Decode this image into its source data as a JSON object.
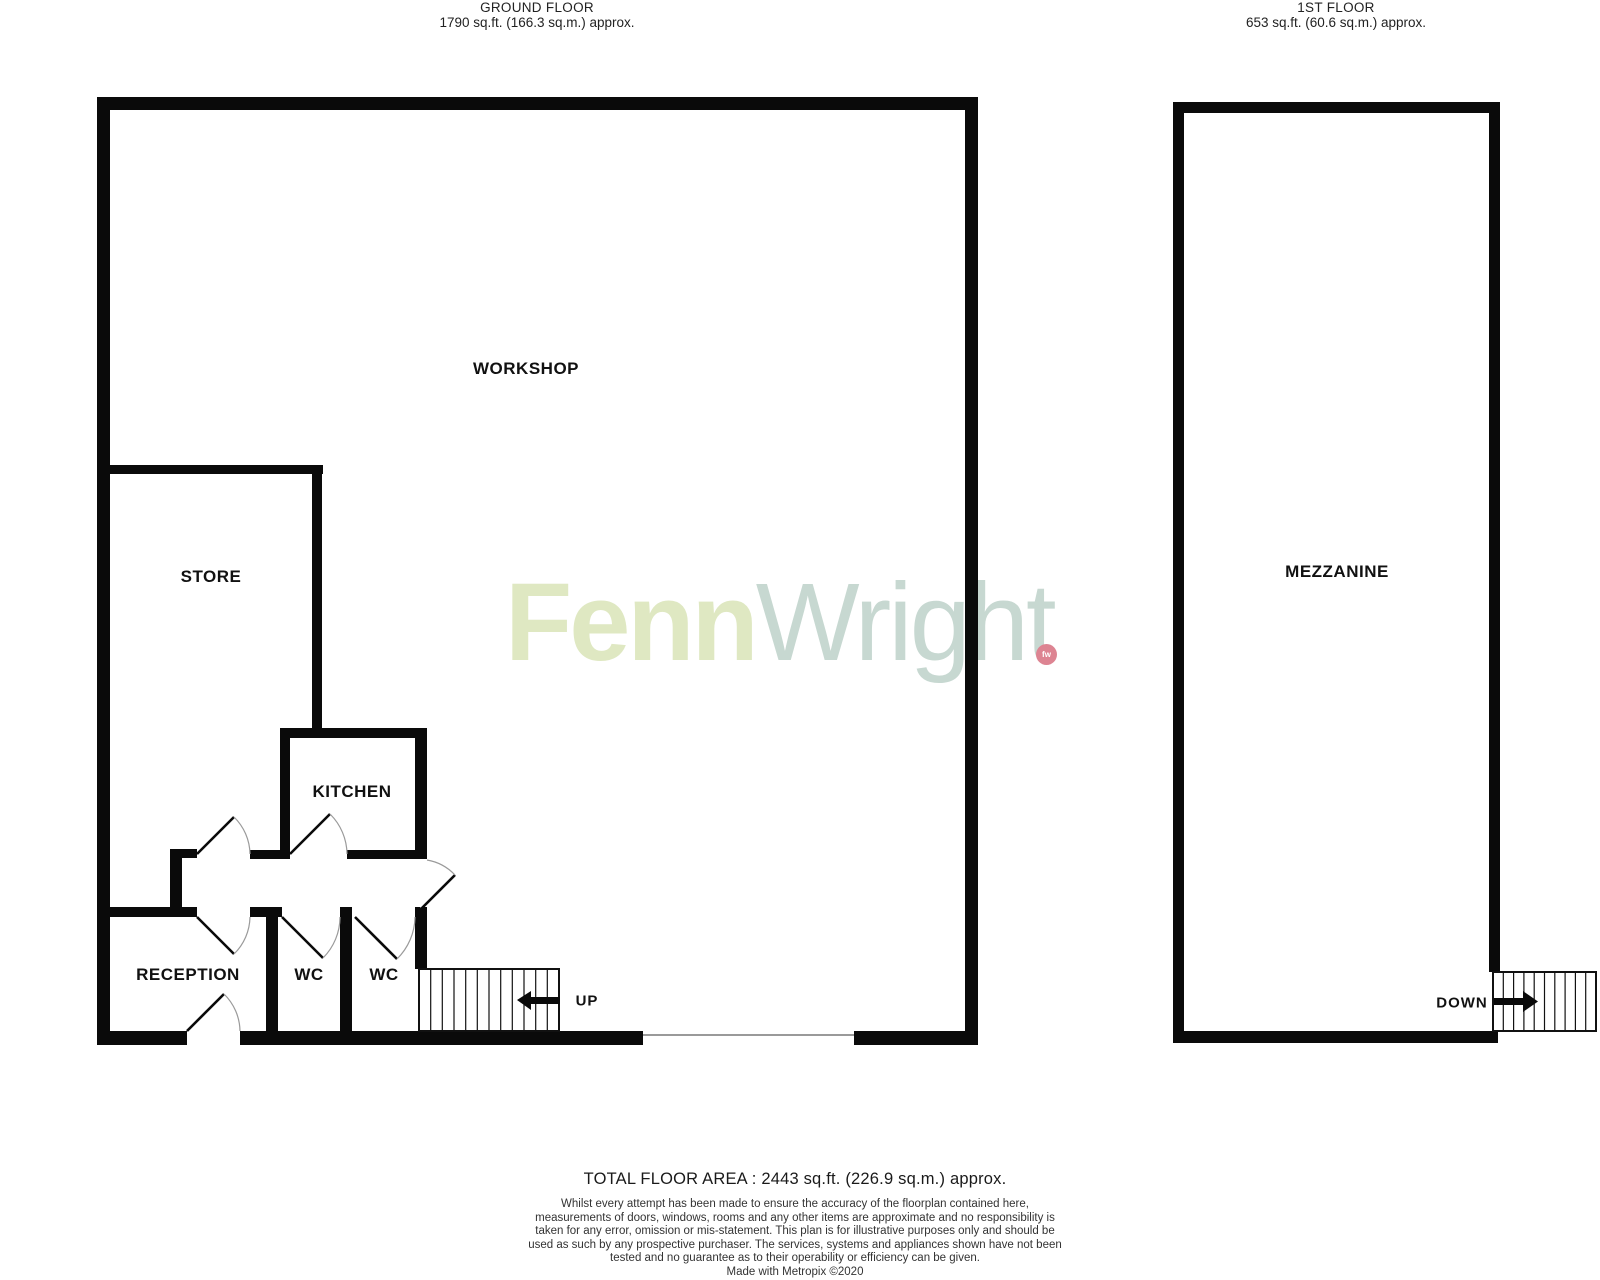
{
  "headers": {
    "ground": {
      "title": "GROUND FLOOR",
      "area": "1790 sq.ft. (166.3 sq.m.) approx."
    },
    "first": {
      "title": "1ST FLOOR",
      "area": "653 sq.ft. (60.6 sq.m.) approx."
    }
  },
  "ground_floor": {
    "rooms": {
      "workshop": "WORKSHOP",
      "store": "STORE",
      "kitchen": "KITCHEN",
      "reception": "RECEPTION",
      "wc1": "WC",
      "wc2": "WC"
    },
    "stairs_label": "UP"
  },
  "first_floor": {
    "rooms": {
      "mezzanine": "MEZZANINE"
    },
    "stairs_label": "DOWN"
  },
  "watermark": {
    "part1": "Fenn",
    "part2": "Wright",
    "dot_text": "fw",
    "colors": {
      "part1": "#dfe8c2",
      "part2": "#c7d8d1",
      "dot": "#dd8492"
    }
  },
  "footer": {
    "total": "TOTAL FLOOR AREA : 2443 sq.ft. (226.9 sq.m.) approx.",
    "disclaimer": "Whilst every attempt has been made to ensure the accuracy of the floorplan contained here, measurements of doors, windows, rooms and any other items are approximate and no responsibility is taken for any error, omission or mis-statement. This plan is for illustrative purposes only and should be used as such by any prospective purchaser. The services, systems and appliances shown have not been tested and no guarantee as to their operability or efficiency can be given.",
    "credit": "Made with Metropix ©2020"
  },
  "style_colors": {
    "walls": "#0a0a0a",
    "door_arc": "#9a9a9a",
    "text": "#111111"
  }
}
